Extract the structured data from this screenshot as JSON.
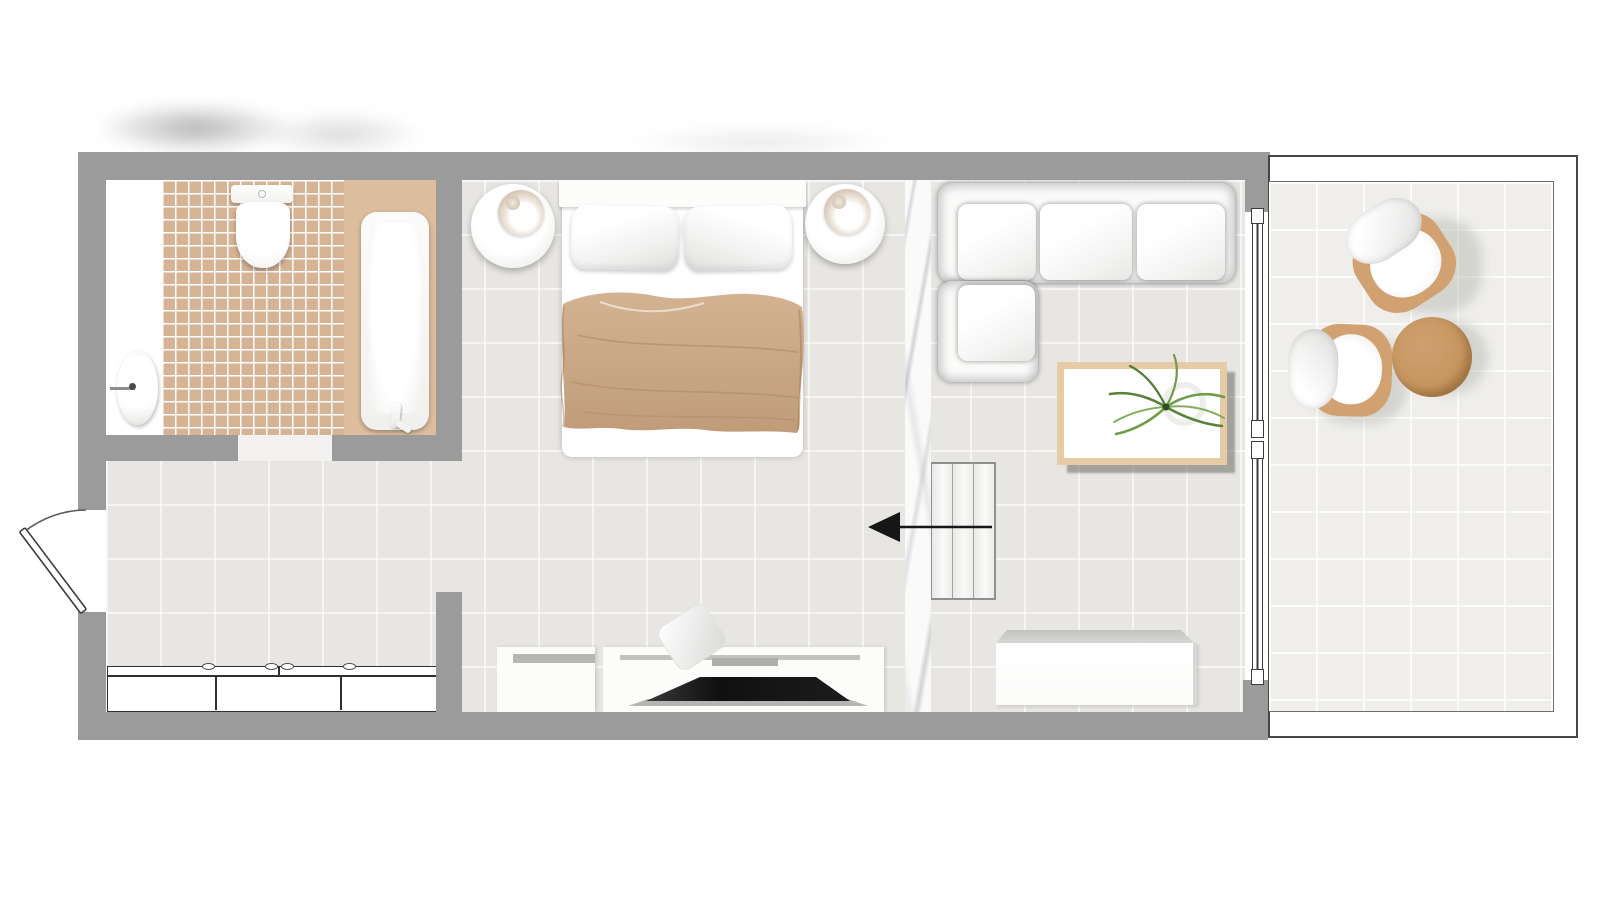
{
  "document": {
    "type": "floor-plan",
    "subject": "studio hotel room with bathroom, bedroom, living area and balcony",
    "view": "top-down architectural plan",
    "visible_text": ""
  },
  "rooms": [
    {
      "id": "bathroom",
      "label": "Bathroom",
      "items": [
        "washbasin",
        "faucet",
        "toilet",
        "cistern",
        "bathtub",
        "tub-platform",
        "mosaic-tile-floor"
      ]
    },
    {
      "id": "hallway",
      "label": "Entrance hallway",
      "items": [
        "entrance-door",
        "door-swing-arc",
        "built-in-wardrobe"
      ],
      "wardrobe_sections": 3,
      "wardrobe_handles": 4
    },
    {
      "id": "bedroom",
      "label": "Bedroom",
      "items": [
        "double-bed",
        "pillow-left",
        "pillow-right",
        "blanket",
        "bedside-table-left",
        "table-lamp-left",
        "bedside-table-right",
        "table-lamp-right",
        "small-cabinet",
        "tv-console",
        "flat-screen-tv",
        "decor-object"
      ]
    },
    {
      "id": "living",
      "label": "Living area",
      "items": [
        "corner-sofa",
        "coffee-table",
        "potted-plant",
        "sideboard",
        "sliding-partition",
        "direction-arrow",
        "marble-partition-wall"
      ],
      "sofa_seats": 4,
      "sliding_partition_columns": 3,
      "arrow_direction": "left"
    },
    {
      "id": "balcony",
      "label": "Balcony",
      "items": [
        "armchair-top",
        "armchair-bottom",
        "round-side-table",
        "sliding-glass-door"
      ],
      "glass_door_segments": 2
    }
  ],
  "palette": {
    "wall_gray": "#9b9b9b",
    "floor_tile": "#e8e6e3",
    "floor_grout": "#f4f2ef",
    "balcony_tile": "#efeeeb",
    "bathroom_tile": "#d6b394",
    "bathroom_grout": "#ffffff",
    "tub_platform": "#dcbd9e",
    "blanket_tan": "#c9a786",
    "chair_wood": "#d2a171",
    "side_table_wood": "#c79964",
    "coffee_table_frame": "#e6cba6",
    "tv_black": "#141414",
    "plant_green": "#57823a",
    "outline_dark": "#3c3c3c",
    "marble_vein": "#aaacb2"
  }
}
